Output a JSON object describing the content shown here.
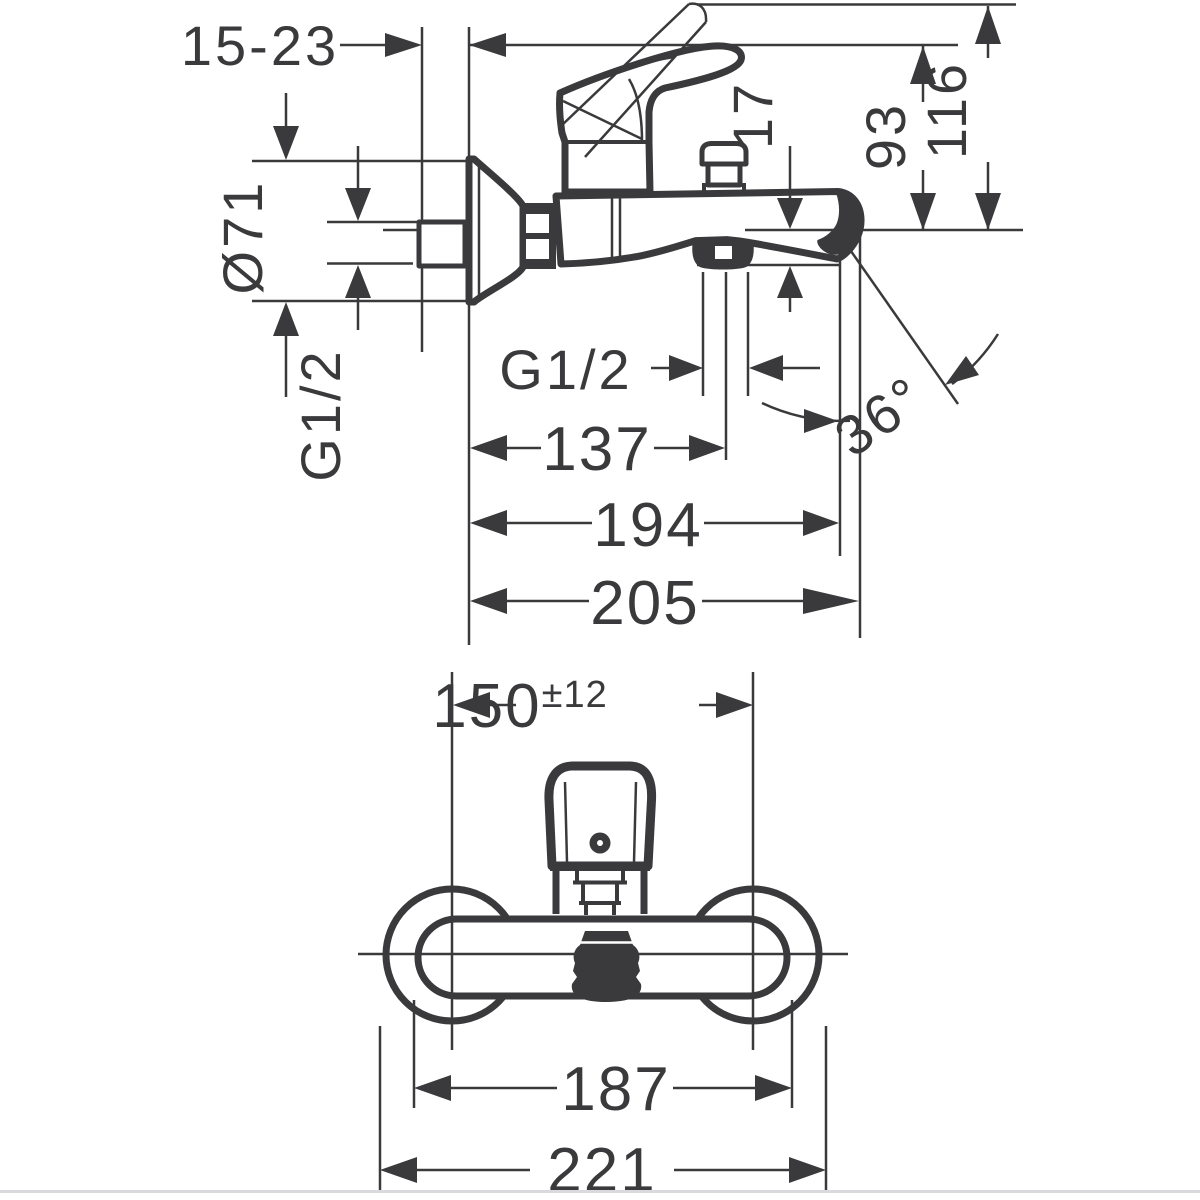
{
  "colors": {
    "ink": "#3a3a3c",
    "paper": "#ffffff",
    "page_edge": "#d9d9de"
  },
  "side_view": {
    "wall_depth": "15-23",
    "escutcheon_diameter": "Ø71",
    "inlet_thread": "G1/2",
    "outlet_thread": "G1/2",
    "spout_drop": "17",
    "height_to_body_top": "93",
    "height_to_handle_top": "116",
    "outlet_center_reach": "137",
    "spout_reach": "194",
    "total_reach": "205",
    "spout_angle": "36°"
  },
  "front_view": {
    "connection_distance": "150",
    "connection_tolerance": "±12",
    "body_width": "187",
    "total_width": "221"
  }
}
